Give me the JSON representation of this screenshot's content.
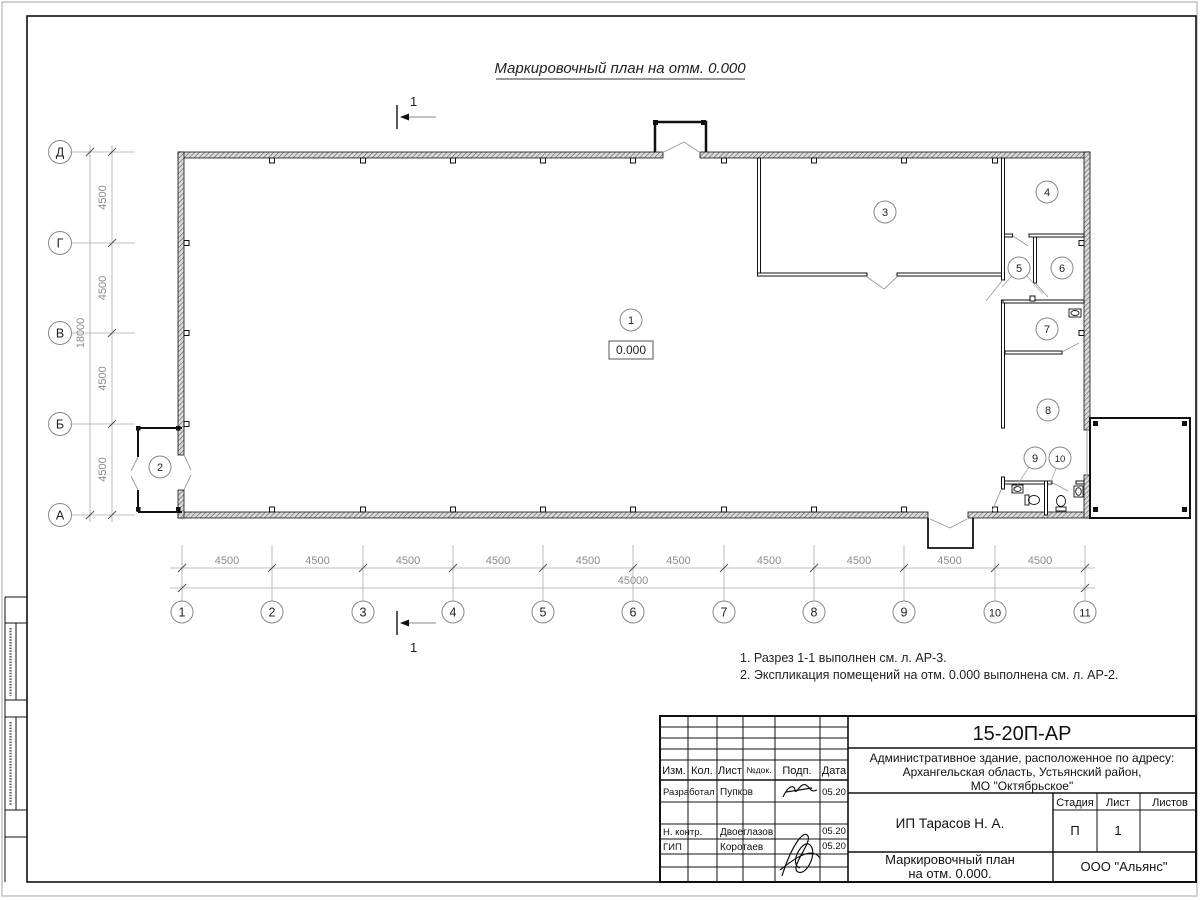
{
  "sheet": {
    "title": "Маркировочный план на отм. 0.000",
    "notes": [
      "1. Разрез 1-1 выполнен см. л. АР-3.",
      "2. Экспликация помещений на отм. 0.000 выполнена см. л. АР-2."
    ]
  },
  "plan": {
    "elevation_mark": "0.000",
    "section_label": "1",
    "rooms": [
      "1",
      "2",
      "3",
      "4",
      "5",
      "6",
      "7",
      "8",
      "9",
      "10"
    ],
    "col_axes": [
      "1",
      "2",
      "3",
      "4",
      "5",
      "6",
      "7",
      "8",
      "9",
      "10",
      "11"
    ],
    "row_axes": [
      "Д",
      "Г",
      "В",
      "Б",
      "А"
    ],
    "dims_bottom_segments": [
      "4500",
      "4500",
      "4500",
      "4500",
      "4500",
      "4500",
      "4500",
      "4500",
      "4500",
      "4500"
    ],
    "dim_bottom_total": "45000",
    "dims_left_segments": [
      "4500",
      "4500",
      "4500",
      "4500"
    ],
    "dim_left_total": "18000"
  },
  "titleblock": {
    "doc_number": "15-20П-АР",
    "project_lines": [
      "Административное здание, расположенное по адресу:",
      "Архангельская область, Устьянский район,",
      "МО \"Октябрьское\""
    ],
    "client": "ИП Тарасов Н. А.",
    "drawing_name_lines": [
      "Маркировочный план",
      "на отм. 0.000."
    ],
    "company": "ООО \"Альянс\"",
    "columns": [
      "Изм.",
      "Кол.",
      "Лист",
      "№док.",
      "Подп.",
      "Дата"
    ],
    "stage_cols": [
      "Стадия",
      "Лист",
      "Листов"
    ],
    "stage_value": "П",
    "sheet_value": "1",
    "signature_rows": [
      {
        "role": "Разработал",
        "name": "Пупков",
        "date": "05.20"
      },
      {
        "role": "Н. контр.",
        "name": "Двоеглазов",
        "date": "05.20"
      },
      {
        "role": "ГИП",
        "name": "Коротаев",
        "date": "05.20"
      }
    ]
  },
  "colors": {
    "line": "#1a1a1a",
    "dim_gray": "#8c8c8c",
    "hatch": "#555"
  }
}
